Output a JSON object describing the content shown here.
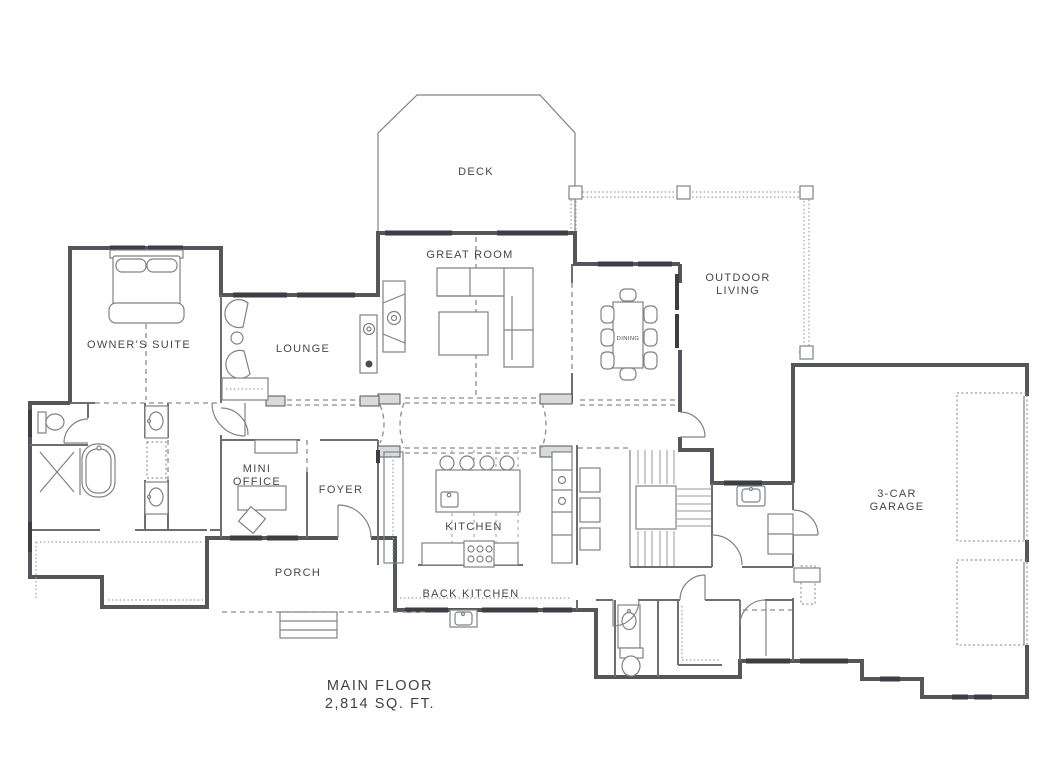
{
  "plan_title": {
    "line1": "MAIN FLOOR",
    "line2": "2,814 SQ. FT."
  },
  "rooms": {
    "deck": {
      "label": "DECK"
    },
    "great_room": {
      "label": "GREAT ROOM"
    },
    "outdoor_living": {
      "line1": "OUTDOOR",
      "line2": "LIVING"
    },
    "owners_suite": {
      "label": "OWNER'S SUITE"
    },
    "lounge": {
      "label": "LOUNGE"
    },
    "dining": {
      "label": "DINING"
    },
    "mini_office": {
      "line1": "MINI",
      "line2": "OFFICE"
    },
    "foyer": {
      "label": "FOYER"
    },
    "kitchen": {
      "label": "KITCHEN"
    },
    "back_kitchen": {
      "label": "BACK KITCHEN"
    },
    "porch": {
      "label": "PORCH"
    },
    "garage": {
      "line1": "3-CAR",
      "line2": "GARAGE"
    }
  },
  "colors": {
    "background": "#ffffff",
    "exterior_wall": "#55565a",
    "interior_wall": "#6d6e71",
    "window": "#3d3e42",
    "furniture_line": "#808285",
    "dashed_line": "#8a8c8f",
    "text": "#45474a"
  }
}
